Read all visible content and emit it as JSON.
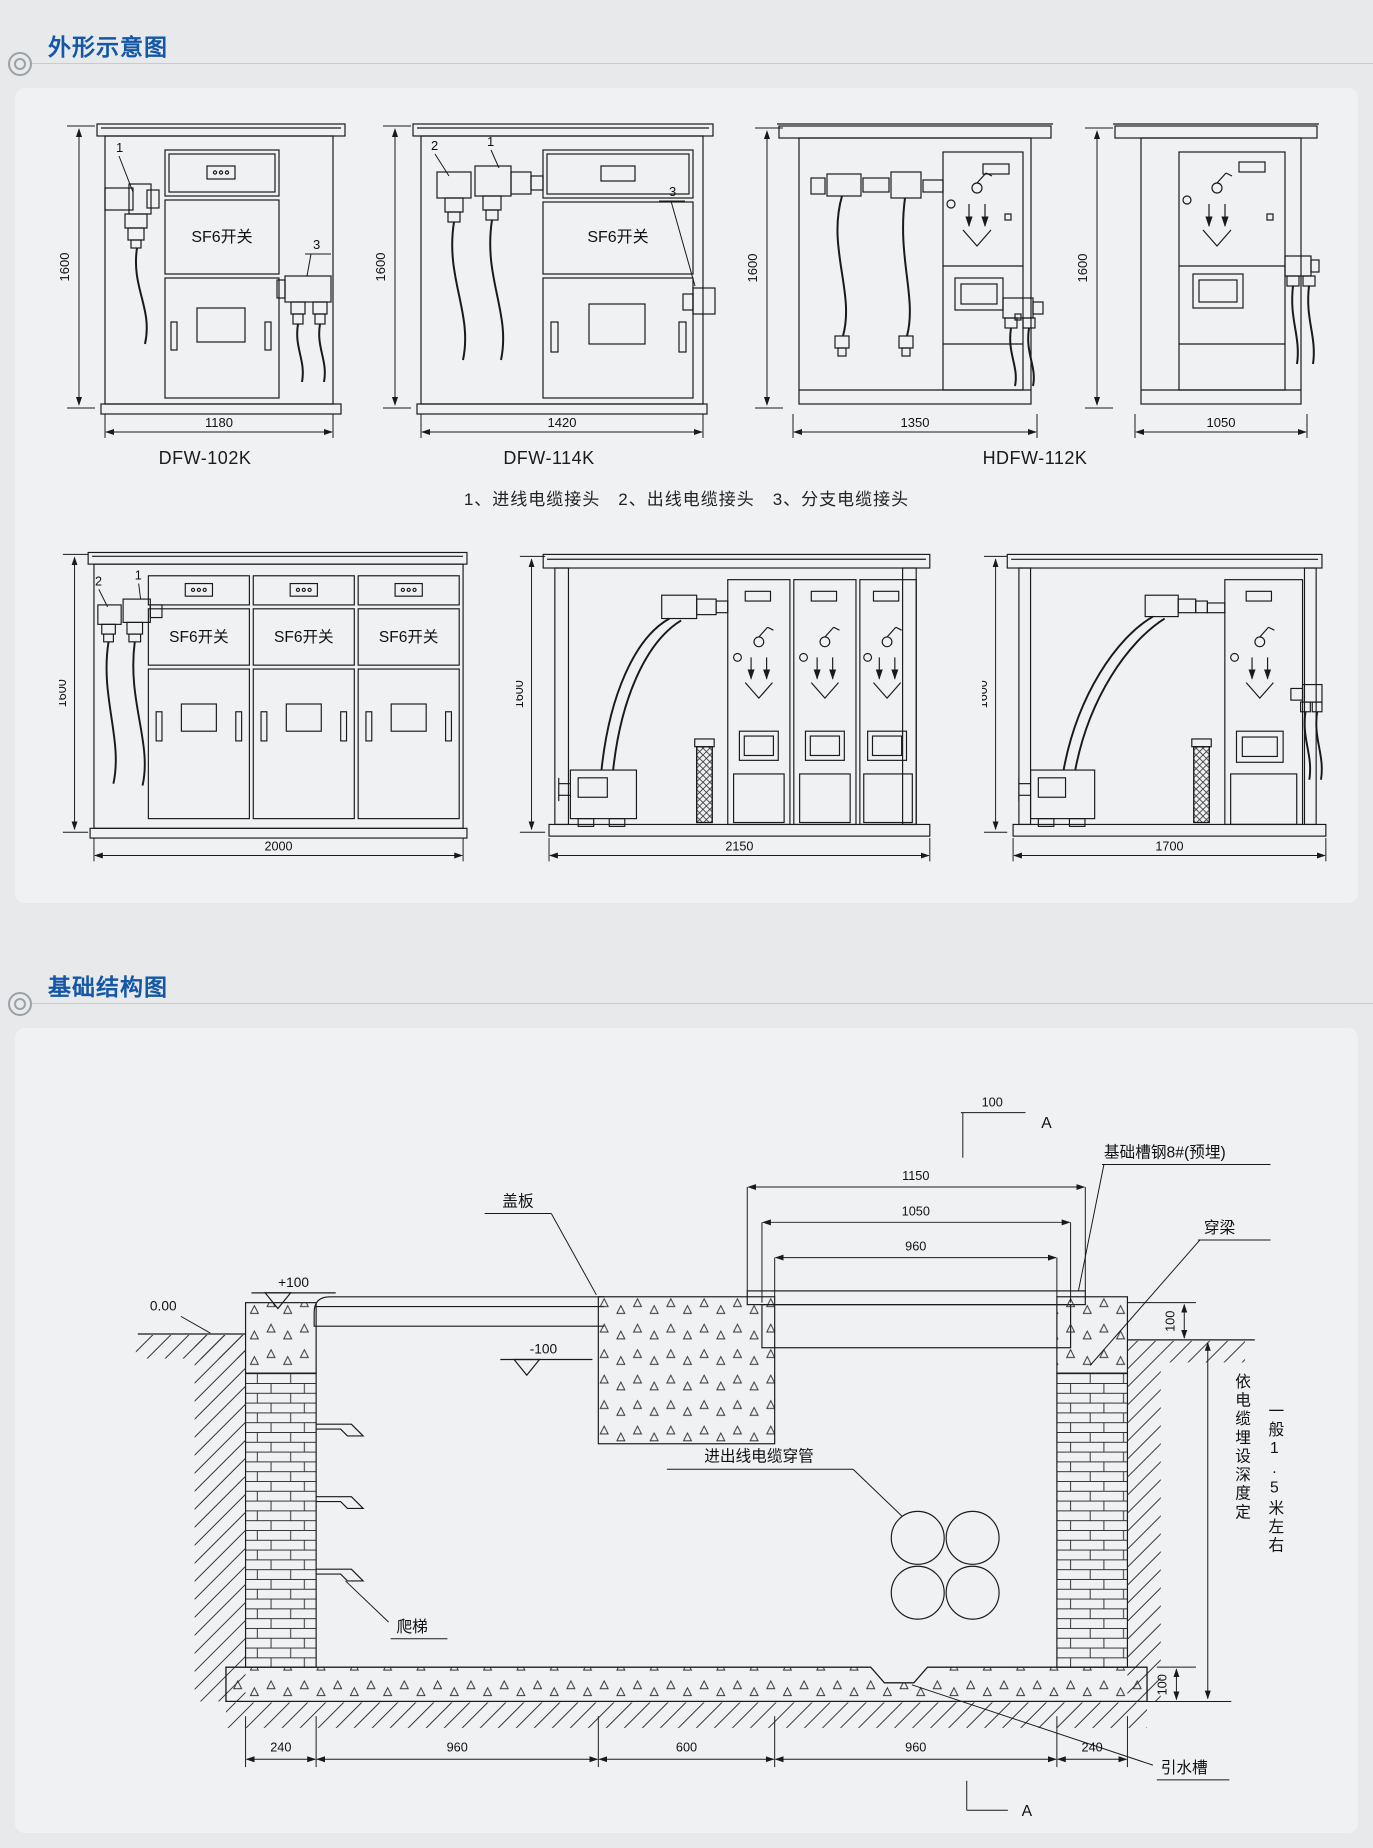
{
  "sections": {
    "outline_title": "外形示意图",
    "foundation_title": "基础结构图"
  },
  "outline": {
    "caption": "1、进线电缆接头　2、出线电缆接头　3、分支电缆接头",
    "sf6_label": "SF6开关",
    "callouts": {
      "c1": "1",
      "c2": "2",
      "c3": "3"
    },
    "height": "1600",
    "models": {
      "a": {
        "name": "DFW-102K",
        "width": "1180"
      },
      "b": {
        "name": "DFW-114K",
        "width": "1420"
      },
      "cd": {
        "name": "HDFW-112K",
        "width_c": "1350",
        "width_d": "1050"
      },
      "e": {
        "width": "2000"
      },
      "f": {
        "width": "2150"
      },
      "g": {
        "width": "1700"
      }
    }
  },
  "foundation": {
    "dims": {
      "top_marker": "100",
      "w1150": "1150",
      "w1050": "1050",
      "w960": "960",
      "right_100": "100",
      "floor_100": "100",
      "b240l": "240",
      "b960l": "960",
      "b600": "600",
      "b960r": "960",
      "b240r": "240"
    },
    "levels": {
      "zero": "0.00",
      "plus": "+100",
      "minus": "-100"
    },
    "labels": {
      "cover": "盖板",
      "channel": "基础槽钢8#(预埋)",
      "beam": "穿梁",
      "pipes": "进出线电缆穿管",
      "ladder": "爬梯",
      "drain": "引水槽",
      "depth1": "依电缆埋设深度定",
      "depth2": "一般1.5米左右",
      "section": "A"
    }
  }
}
